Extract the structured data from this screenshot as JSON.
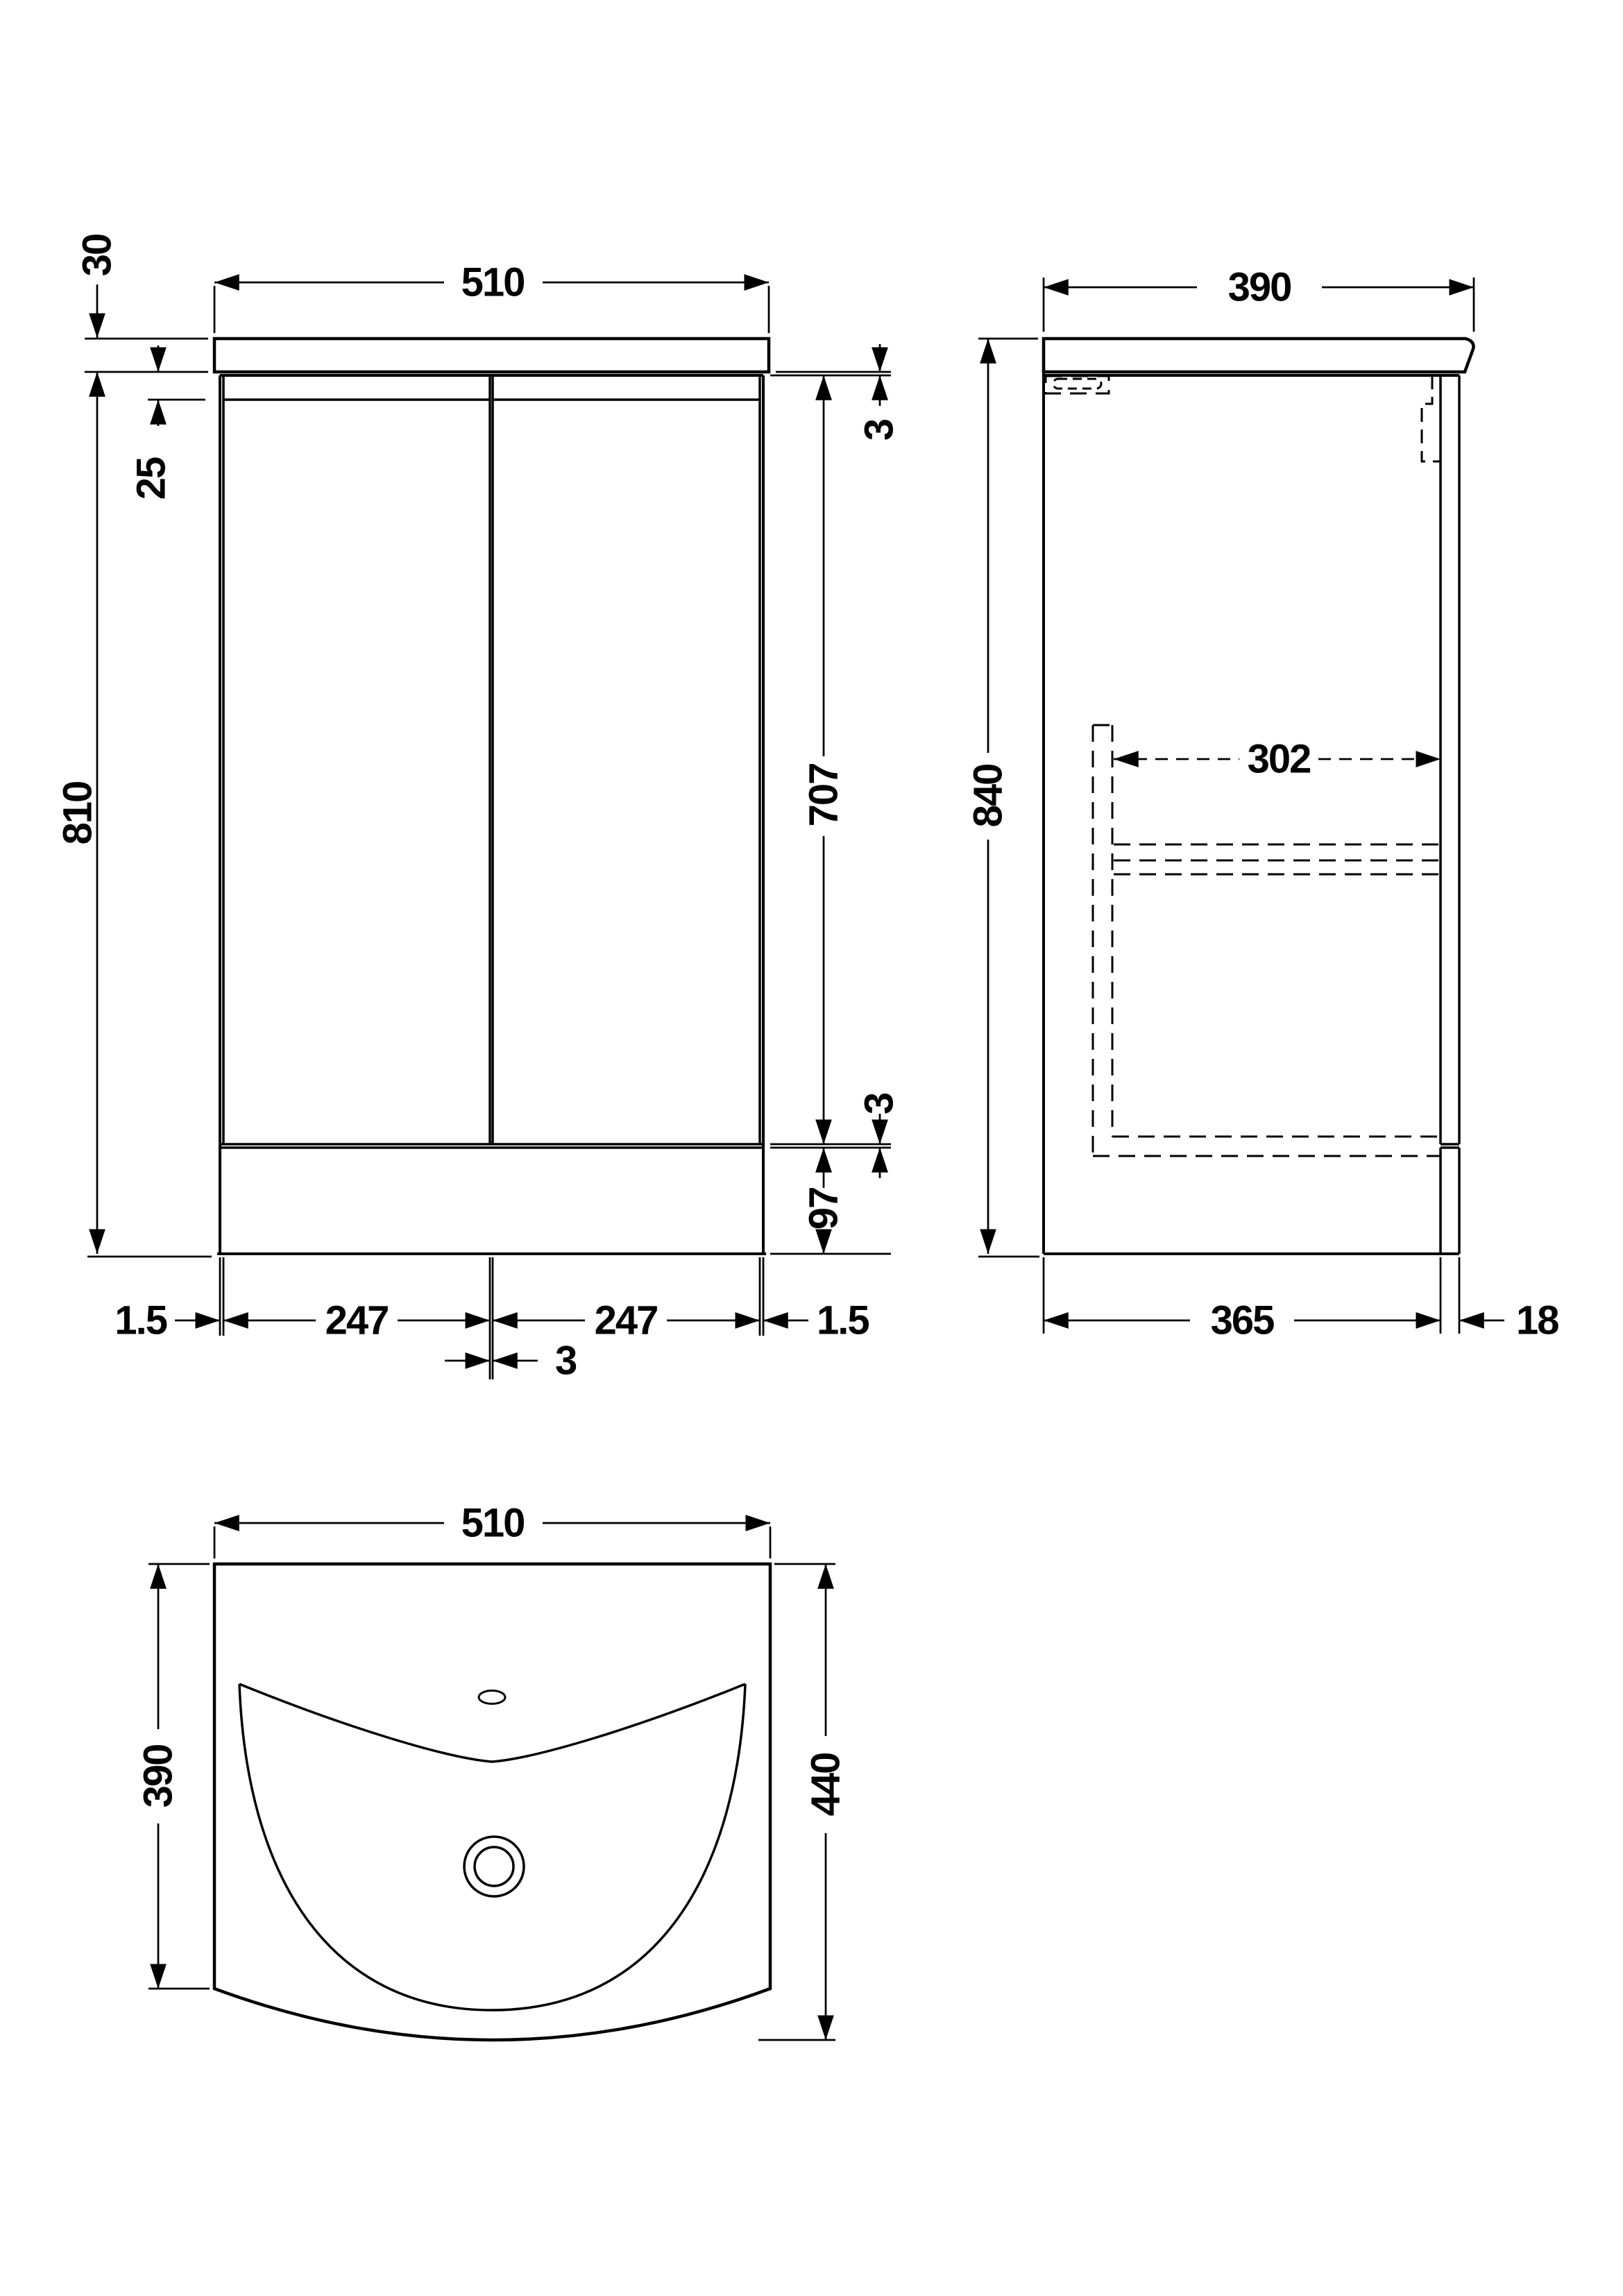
{
  "document": {
    "type": "technical dimension drawing",
    "subject": "floor-standing vanity unit with basin",
    "units": "mm",
    "line_color": "#000000",
    "background_color": "#ffffff"
  },
  "views": {
    "front": {
      "name": "front elevation",
      "dims": {
        "counter_width": "510",
        "counter_thickness": "30",
        "top_reveal": "25",
        "cabinet_height": "810",
        "counter_to_door_gap": "3",
        "door_height": "707",
        "door_to_plinth_gap": "3",
        "plinth_height": "97",
        "side_reveal_left": "1.5",
        "door_left_width": "247",
        "door_right_width": "247",
        "side_reveal_right": "1.5",
        "center_door_gap": "3"
      }
    },
    "side": {
      "name": "side elevation",
      "dims": {
        "counter_depth": "390",
        "total_height": "840",
        "internal_depth": "302",
        "carcass_depth": "365",
        "door_thickness": "18"
      }
    },
    "plan": {
      "name": "basin plan view",
      "dims": {
        "basin_width": "510",
        "basin_depth": "390",
        "basin_total_depth": "440"
      }
    }
  }
}
